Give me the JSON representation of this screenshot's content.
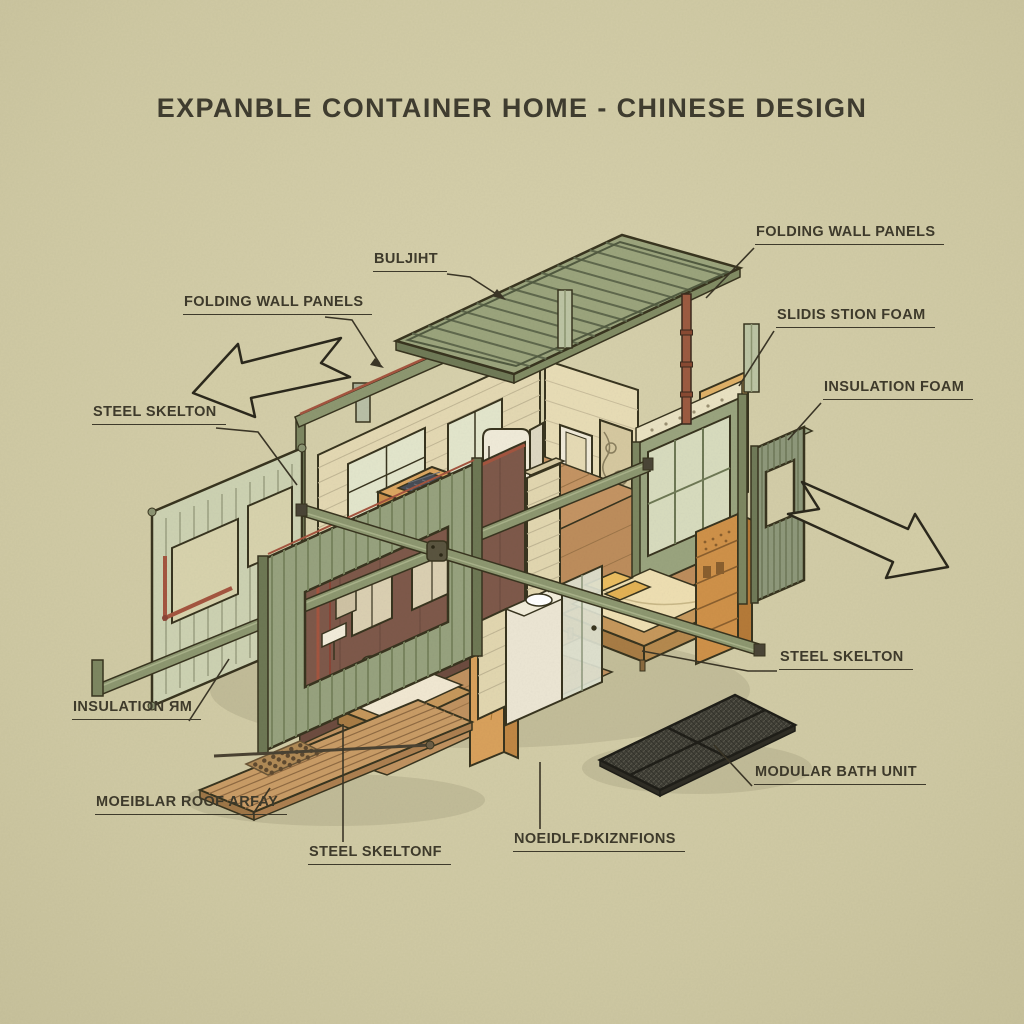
{
  "title": "EXPANBLE CONTAINER HOME - CHINESE DESIGN",
  "labels": {
    "folding_wall_panels_right": "FOLDING WALL PANELS",
    "buljiht": "BULJIHT",
    "folding_wall_panels_left": "FOLDING WALL PANELS",
    "slidis_stion_foam": "SLIDIS STION FOAM",
    "insulation_foam": "INSULATION FOAM",
    "steel_skelton_left": "STEEL SKELTON",
    "insulation_rm": "INSULATION ЯM",
    "steel_skelton_right": "STEEL SKELTON",
    "modular_bath_unit": "MODULAR BATH UNIT",
    "moeiblar_roof_array": "MOEIBLAR ROOF ARFAY",
    "steel_skeltonf": "STEEL SKELTONF",
    "noeioli_dikonions": "NOEIDLF.DKIZNFIONS"
  },
  "diagram": {
    "type": "isometric exploded cutaway illustration",
    "subject": "expandable shipping-container home",
    "parts": [
      "corrugated-roof-panel",
      "steel-skeleton-beams",
      "floating-posts",
      "copper-piping",
      "folding-wall-panel-left-exploded",
      "folding-wall-panel-front",
      "folding-wall-panel-right",
      "brick-interior-walls",
      "kitchen-island",
      "bar-stools",
      "refrigerator",
      "bedroom-window-wall",
      "bed",
      "wardrobe-shelf",
      "second-bed",
      "bathroom-pod",
      "maroon-room",
      "wood-floor",
      "timber-deck",
      "solar-dot-panel",
      "mesh-grate-panel",
      "expansion-arrow-left",
      "expansion-arrow-right"
    ]
  },
  "colors": {
    "paper_bg": "#cfc9a4",
    "ink": "#38341f",
    "label_text": "#3e3a2b",
    "roof_green": "#9ba47c",
    "steel_olive": "#8d9770",
    "panel_green": "#97a27e",
    "brick_cream": "#e4d9b3",
    "wood_tan": "#c49463",
    "deck_wood": "#c99c66",
    "bed_yellow": "#eabd60",
    "cabinet_orange": "#c98f4b",
    "maroon_wall": "#7e594a",
    "copper_pipe": "#a4553f",
    "grate_dark": "#3f3e35",
    "white_unit": "#f0ebd9"
  }
}
